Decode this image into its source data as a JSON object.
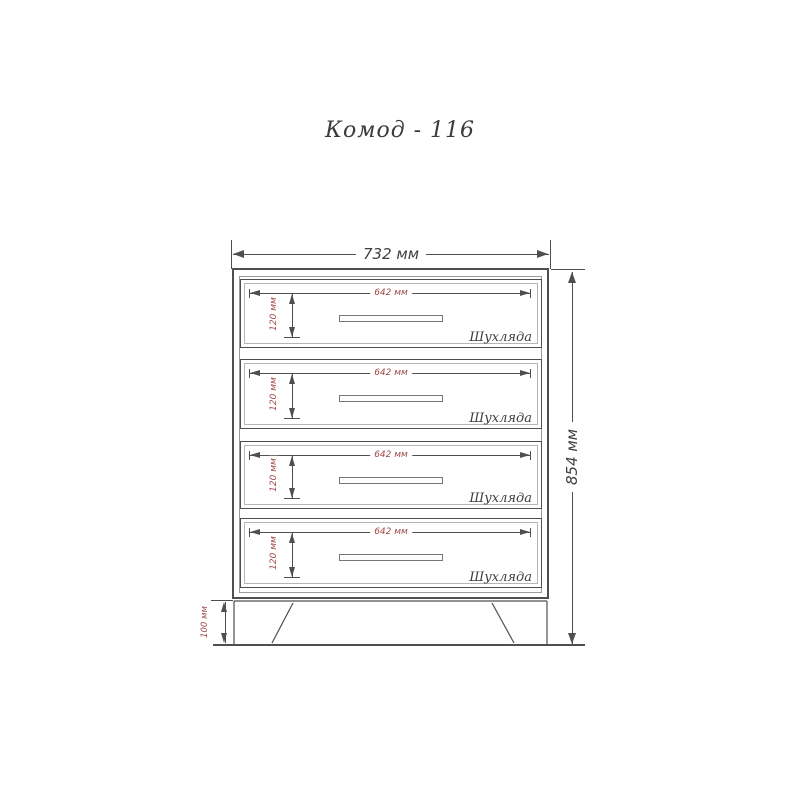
{
  "title": "Комод - 116",
  "dimensions": {
    "overall_width": "732 мм",
    "overall_height": "854 мм",
    "plinth_height": "100 мм"
  },
  "drawers": [
    {
      "width_label": "642 мм",
      "height_label": "120 мм",
      "name_label": "Шухляда"
    },
    {
      "width_label": "642 мм",
      "height_label": "120 мм",
      "name_label": "Шухляда"
    },
    {
      "width_label": "642 мм",
      "height_label": "120 мм",
      "name_label": "Шухляда"
    },
    {
      "width_label": "642 мм",
      "height_label": "120 мм",
      "name_label": "Шухляда"
    }
  ],
  "colors": {
    "line": "#4f4f4f",
    "dimension_text": "#3f3f3f",
    "dimension_accent": "#a04848",
    "background": "#ffffff"
  }
}
